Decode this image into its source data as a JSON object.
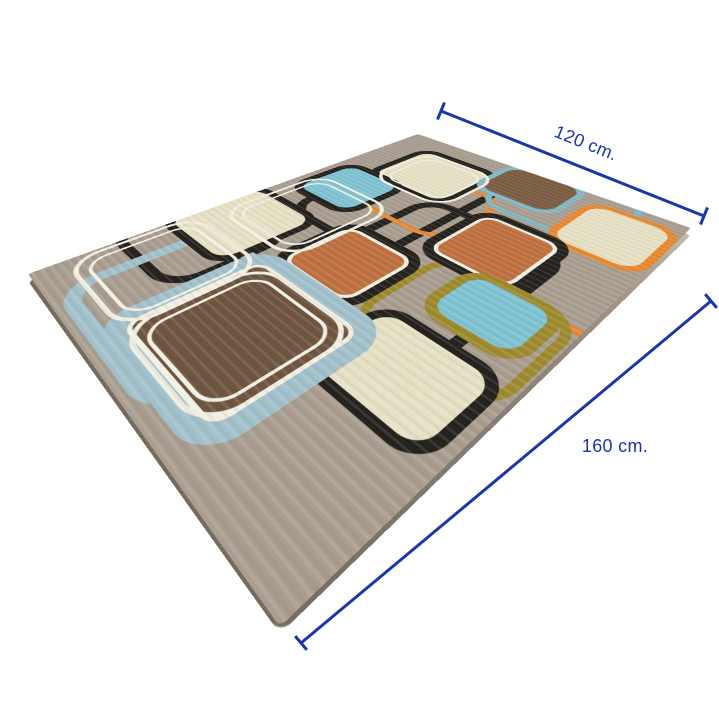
{
  "annotations": {
    "width": {
      "label": "120 cm."
    },
    "length": {
      "label": "160 cm."
    },
    "color": "#1a37a6"
  },
  "rug": {
    "corners": {
      "top": [
        418,
        134
      ],
      "right": [
        691,
        228
      ],
      "left": [
        28,
        274
      ],
      "bottom": [
        280,
        627
      ]
    },
    "edge_offset": 7,
    "face_size": [
      360,
      480
    ],
    "background": "#a89d90",
    "colors": {
      "cream": "#e6e0c4",
      "teal": "#7fc3d3",
      "powder_blue": "#a2c1cc",
      "orange_fill": "#bf7040",
      "orange_line": "#e8882f",
      "brown_dark": "#6e5540",
      "brown_mid": "#7a5c43",
      "olive_line": "#9d8a2e",
      "black_line": "#24211d",
      "white_line": "#f2efe3"
    },
    "elements": [
      {
        "name": "rug-black-pipe",
        "x": 48,
        "y": 36,
        "w": 140,
        "h": 224,
        "r": 34,
        "border": "#24211d",
        "bw": 11
      },
      {
        "name": "rug-black-pipe",
        "x": 138,
        "y": 132,
        "w": 170,
        "h": 224,
        "r": 34,
        "border": "#24211d",
        "bw": 11
      },
      {
        "name": "rug-black-pipe",
        "x": -24,
        "y": 282,
        "w": 130,
        "h": 128,
        "r": 34,
        "border": "#24211d",
        "bw": 10
      },
      {
        "name": "rug-orange-loop",
        "x": 90,
        "y": 84,
        "w": 116,
        "h": 116,
        "r": 32,
        "border": "#e8882f",
        "bw": 7
      },
      {
        "name": "rug-orange-loop",
        "x": 278,
        "y": 88,
        "w": 110,
        "h": 134,
        "r": 32,
        "border": "#e8882f",
        "bw": 7
      },
      {
        "name": "rug-teal-loop",
        "x": 176,
        "y": -16,
        "w": 140,
        "h": 122,
        "r": 32,
        "border": "#7fb7c6",
        "bw": 7
      },
      {
        "name": "rug-olive-loop",
        "x": 222,
        "y": 206,
        "w": 136,
        "h": 122,
        "r": 32,
        "border": "#9d8a2e",
        "bw": 8
      },
      {
        "name": "rug-powder-loop",
        "x": 38,
        "y": 328,
        "w": 182,
        "h": 146,
        "r": 36,
        "border": "#a2c1cc",
        "bw": 13
      },
      {
        "name": "rug-square-cream",
        "x": 42,
        "y": 30,
        "w": 120,
        "h": 114,
        "r": 26,
        "fill": "#e6e0c4",
        "border": "#24211d",
        "bw": 10
      },
      {
        "name": "rug-square-brown",
        "x": 150,
        "y": -8,
        "w": 104,
        "h": 90,
        "r": 26,
        "fill": "#7a5c43",
        "border": "#85b7c6",
        "bw": 8
      },
      {
        "name": "rug-square-cream",
        "x": 264,
        "y": 15,
        "w": 96,
        "h": 106,
        "r": 26,
        "fill": "#e6e0c4",
        "border": "#e8882f",
        "bw": 8
      },
      {
        "name": "rug-square-teal",
        "x": 9,
        "y": 129,
        "w": 100,
        "h": 99,
        "r": 26,
        "fill": "#7fc3d3",
        "border": "#24211d",
        "bw": 10
      },
      {
        "name": "rug-square-orange",
        "x": 195,
        "y": 111,
        "w": 106,
        "h": 112,
        "r": 26,
        "fill": "#bf7040",
        "border": "#24211d",
        "bw": 10,
        "inner": "#f2efe3",
        "iw": 4
      },
      {
        "name": "rug-square-orange",
        "x": 117,
        "y": 225,
        "w": 106,
        "h": 103,
        "r": 26,
        "fill": "#bf7040",
        "border": "#24211d",
        "bw": 10,
        "inner": "#f2efe3",
        "iw": 4
      },
      {
        "name": "rug-square-cream",
        "x": -15,
        "y": 246,
        "w": 116,
        "h": 118,
        "r": 26,
        "fill": "#e6e0c4",
        "border": "#24211d",
        "bw": 9
      },
      {
        "name": "rug-square-teal",
        "x": 252,
        "y": 204,
        "w": 94,
        "h": 80,
        "r": 26,
        "fill": "#7fc3d3",
        "border": "#9d8a2e",
        "bw": 10
      },
      {
        "name": "rug-square-cream",
        "x": 234,
        "y": 292,
        "w": 118,
        "h": 92,
        "r": 26,
        "fill": "#e6e0c4",
        "border": "#24211d",
        "bw": 9
      },
      {
        "name": "rug-square-brown",
        "x": 102,
        "y": 315,
        "w": 162,
        "h": 152,
        "r": 30,
        "fill": "#6e5540",
        "border": "#a2c1cc",
        "bw": 16,
        "inner": "#f2efe3",
        "iw": 4
      },
      {
        "name": "rug-white-loop",
        "x": 54,
        "y": 40,
        "w": 110,
        "h": 104,
        "r": 30,
        "border": "#f2efe3",
        "bw": 4,
        "double": true
      },
      {
        "name": "rug-white-loop",
        "x": 12,
        "y": 180,
        "w": 122,
        "h": 132,
        "r": 30,
        "border": "#f2efe3",
        "bw": 4,
        "double": true
      },
      {
        "name": "rug-white-loop",
        "x": 3,
        "y": 332,
        "w": 124,
        "h": 122,
        "r": 30,
        "border": "#f2efe3",
        "bw": 4,
        "double": true
      },
      {
        "name": "rug-white-loop",
        "x": 122,
        "y": 332,
        "w": 126,
        "h": 124,
        "r": 30,
        "border": "#f2efe3",
        "bw": 4,
        "double": true
      }
    ]
  }
}
